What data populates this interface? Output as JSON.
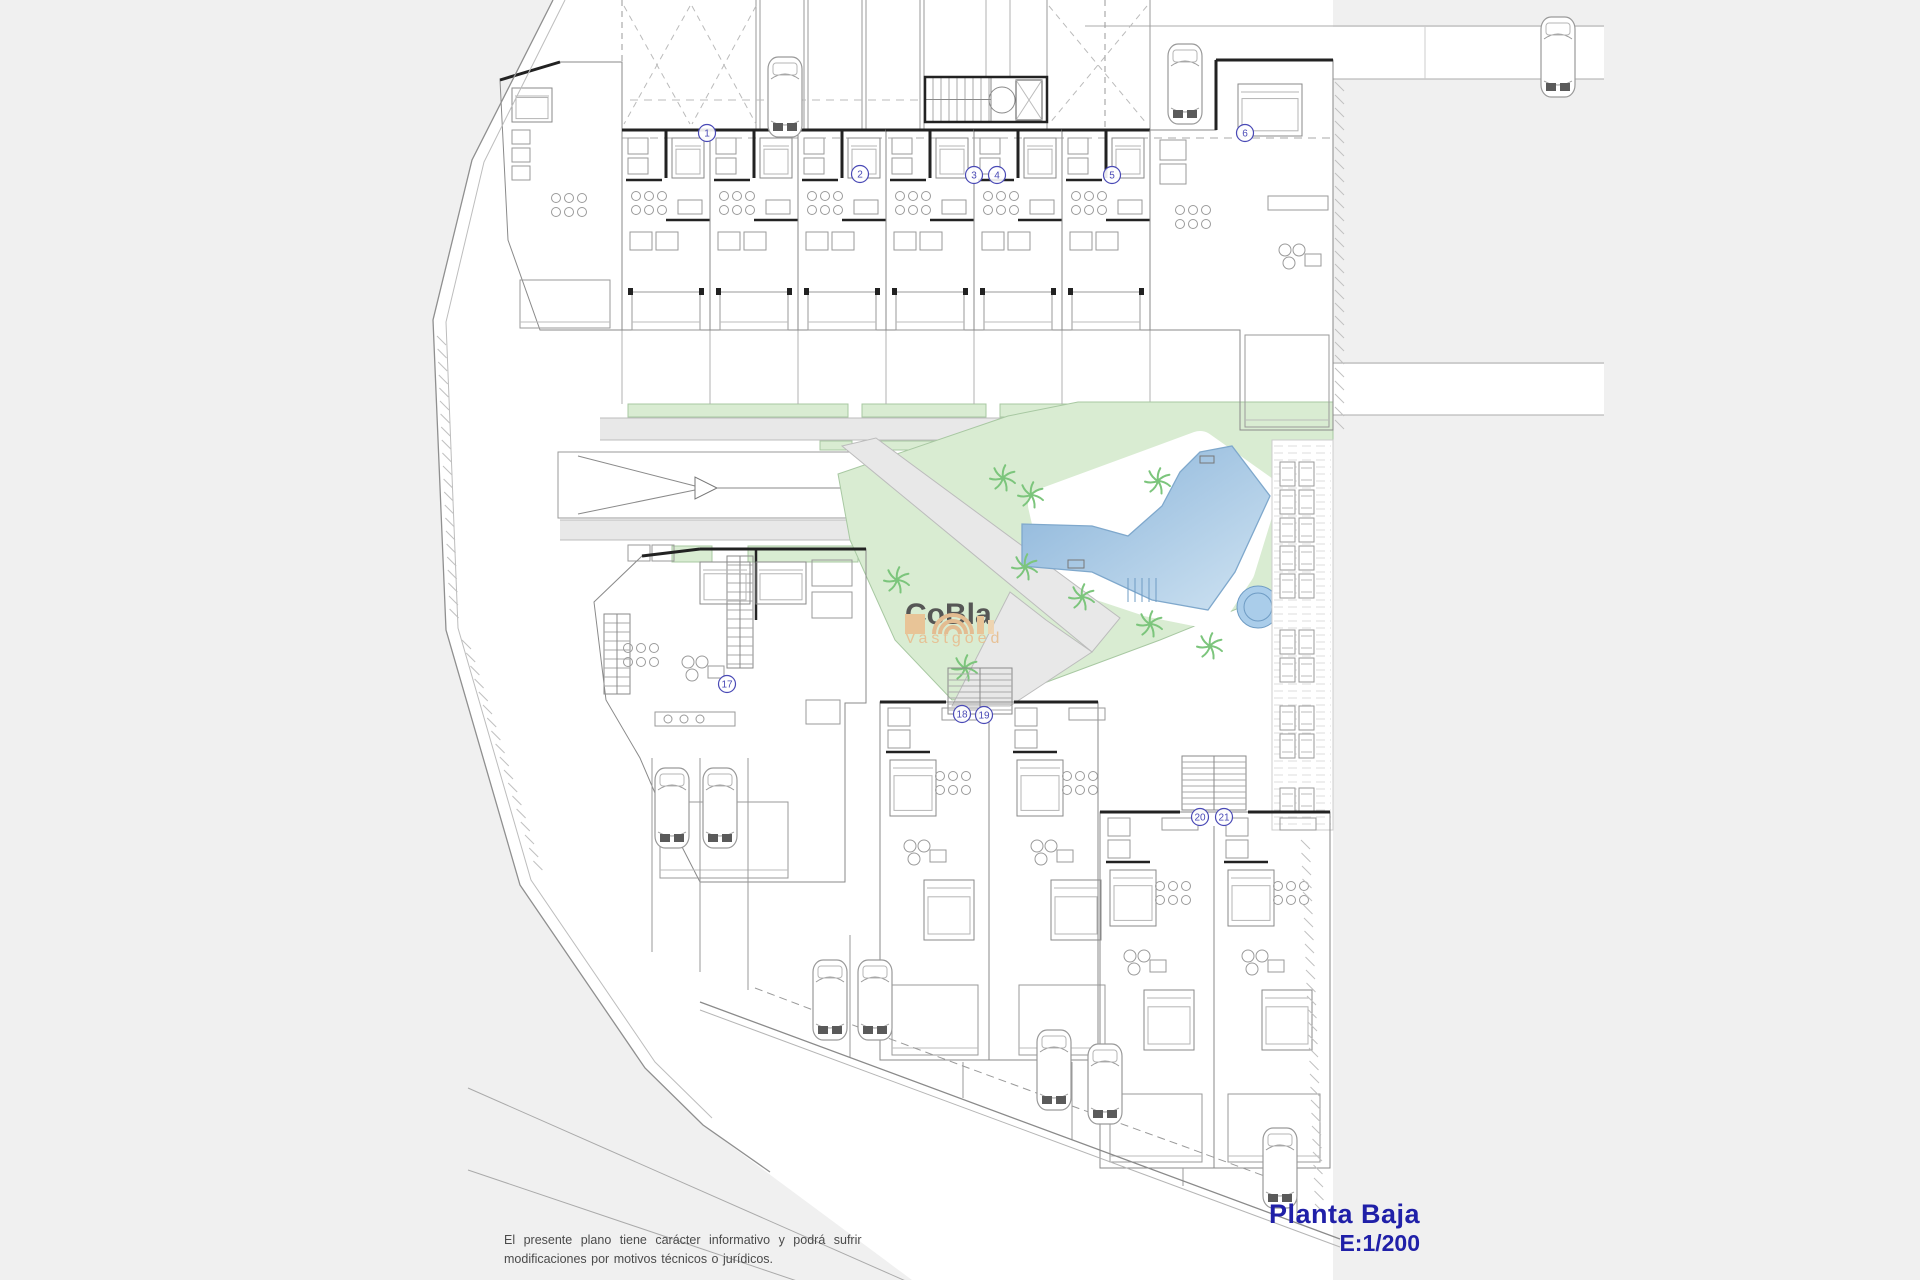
{
  "app": {
    "type": "architectural-floor-plan"
  },
  "title_block": {
    "plan_label": "Planta Baja",
    "scale_label": "E:1/200"
  },
  "disclaimer": {
    "line1": "El presente plano tiene carácter informativo y podrá sufrir",
    "line2": "modificaciones por motivos técnicos o jurídicos."
  },
  "logo": {
    "brand": "CoBla",
    "subtitle": "Vastgoed"
  },
  "plan": {
    "unit_labels_top": [
      {
        "n": "1",
        "x": 707,
        "y": 133
      },
      {
        "n": "2",
        "x": 860,
        "y": 174
      },
      {
        "n": "3",
        "x": 974,
        "y": 175
      },
      {
        "n": "4",
        "x": 997,
        "y": 175
      },
      {
        "n": "5",
        "x": 1112,
        "y": 175
      },
      {
        "n": "6",
        "x": 1245,
        "y": 133
      }
    ],
    "unit_labels_bottom": [
      {
        "n": "17",
        "x": 727,
        "y": 684
      },
      {
        "n": "18",
        "x": 962,
        "y": 714
      },
      {
        "n": "19",
        "x": 984,
        "y": 715
      },
      {
        "n": "20",
        "x": 1200,
        "y": 817
      },
      {
        "n": "21",
        "x": 1224,
        "y": 817
      }
    ],
    "cars_top": [
      [
        785,
        97
      ],
      [
        1185,
        84
      ],
      [
        1558,
        57
      ]
    ],
    "cars_parking": [
      [
        672,
        808
      ],
      [
        720,
        808
      ],
      [
        830,
        1000
      ],
      [
        875,
        1000
      ],
      [
        1054,
        1070
      ],
      [
        1105,
        1084
      ],
      [
        1280,
        1168
      ]
    ],
    "palms": [
      [
        1003,
        478
      ],
      [
        1031,
        495
      ],
      [
        1158,
        481
      ],
      [
        1082,
        597
      ],
      [
        1025,
        567
      ],
      [
        1150,
        624
      ],
      [
        1210,
        646
      ],
      [
        965,
        668
      ],
      [
        897,
        580
      ]
    ],
    "loungers_y": [
      462,
      490,
      518,
      546,
      574,
      630,
      658,
      706,
      734,
      788
    ],
    "colors": {
      "background": "#f0f0f0",
      "site": "#ffffff",
      "wall": "#222222",
      "line": "#9a9a9a",
      "line_light": "#c3c3c3",
      "green": "#d9ecd2",
      "green_edge": "#a8c8a2",
      "path": "#e8e8e8",
      "path_edge": "#bcbcbc",
      "pool_deep": "#86b1d8",
      "pool_pale": "#cfe3f2",
      "pool_edge": "#7fa8cc",
      "palm": "#7cc57c",
      "navy": "#2020a8",
      "label_blue": "#4a4ab6",
      "logo_text": "#4f4f4f",
      "logo_accent": "#e4ba8e",
      "disclaimer": "#4a4a4a"
    }
  }
}
